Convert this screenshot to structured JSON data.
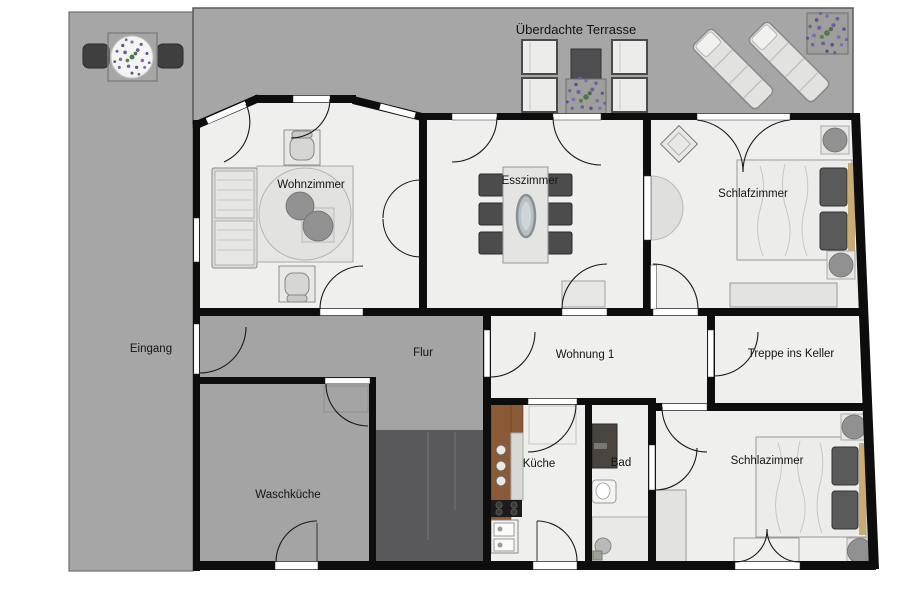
{
  "labels": {
    "terrace": "Überdachte Terrasse",
    "living_room": "Wohnzimmer",
    "dining_room": "Esszimmer",
    "bedroom_top": "Schlafzimmer",
    "entrance": "Eingang",
    "hallway": "Flur",
    "apartment": "Wohnung 1",
    "stairs_basement": "Treppe ins Keller",
    "laundry": "Waschküche",
    "kitchen": "Küche",
    "bathroom": "Bad",
    "bedroom_bottom": "Schhlazimmer"
  },
  "colors": {
    "wall": "#0d0d0d",
    "floor": "#efefed",
    "terrace_gray": "#a6a6a6",
    "hall_gray": "#a4a4a4",
    "stairs_dark": "#59595b",
    "furniture_dark": "#4c4c4c",
    "counter_wood": "#8a5a36",
    "bed_trim": "#c9ab74",
    "plant_purple": "#6f5fa0",
    "plant_green": "#4f7a4f"
  }
}
